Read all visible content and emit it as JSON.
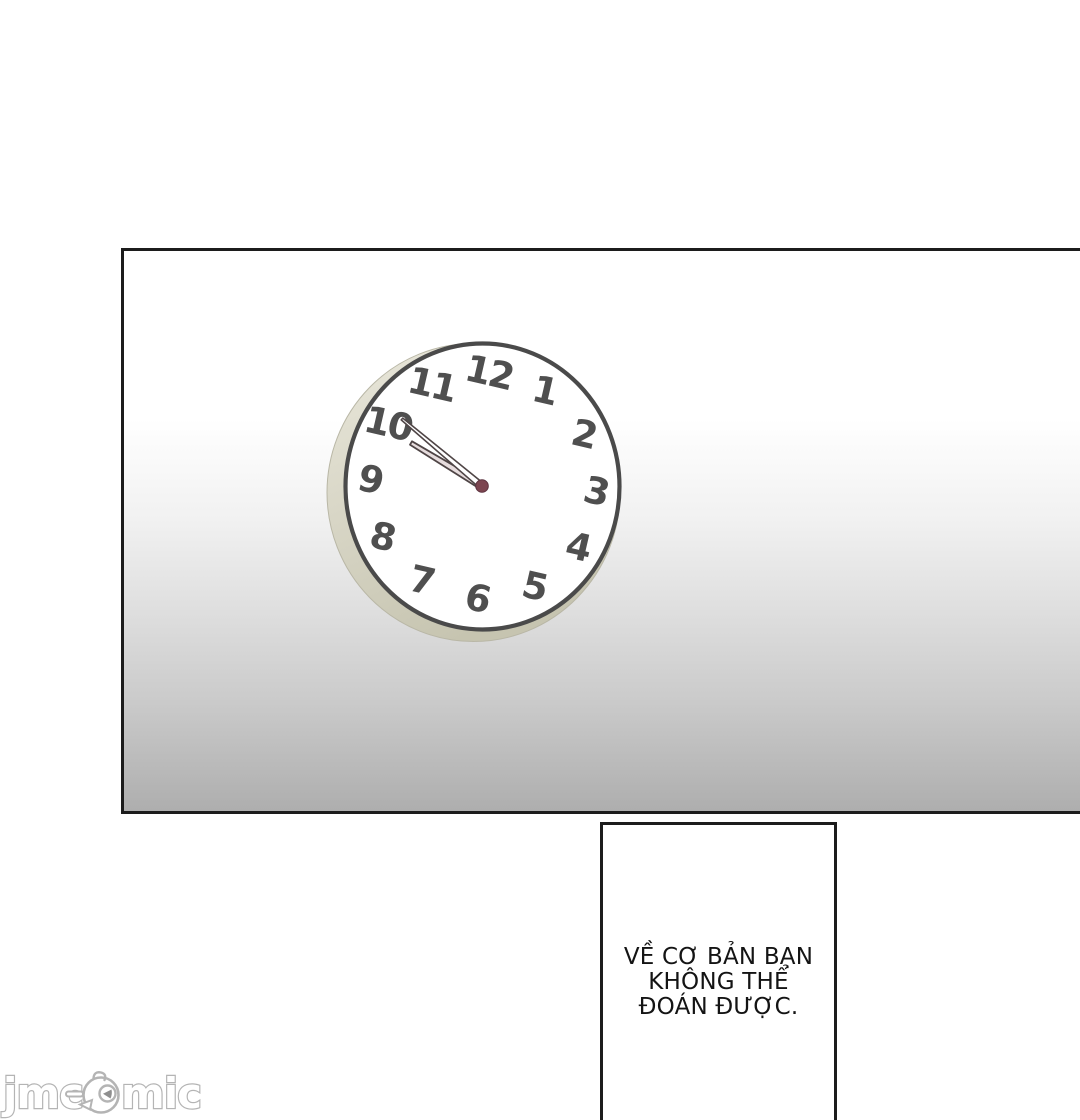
{
  "comic": {
    "caption": {
      "lines": [
        "VỀ CƠ BẢN BẠN",
        "KHÔNG THỂ",
        "ĐOÁN ĐƯỢC."
      ]
    },
    "clock": {
      "numbers": [
        "12",
        "1",
        "2",
        "3",
        "4",
        "5",
        "6",
        "7",
        "8",
        "9",
        "10",
        "11"
      ],
      "time_shown": "9:50",
      "face_color": "#ffffff",
      "outline_color": "#4a4a4a",
      "number_color": "#4f4f4f",
      "rim_color_light": "#eae8dc",
      "rim_color_dark": "#c6c4b0",
      "minute_hand_fill": "#ffffff",
      "hour_hand_fill": "#e6dcdd",
      "center_dot_color": "#7c4550"
    },
    "panels": {
      "border_color": "#1c1c1c",
      "gradient_top": "#ffffff",
      "gradient_bottom": "#aeaeae"
    },
    "watermark": {
      "left": "jmc",
      "right": "mic",
      "full_text": "jmcomic",
      "stroke_color": "#b4b4b4"
    }
  }
}
